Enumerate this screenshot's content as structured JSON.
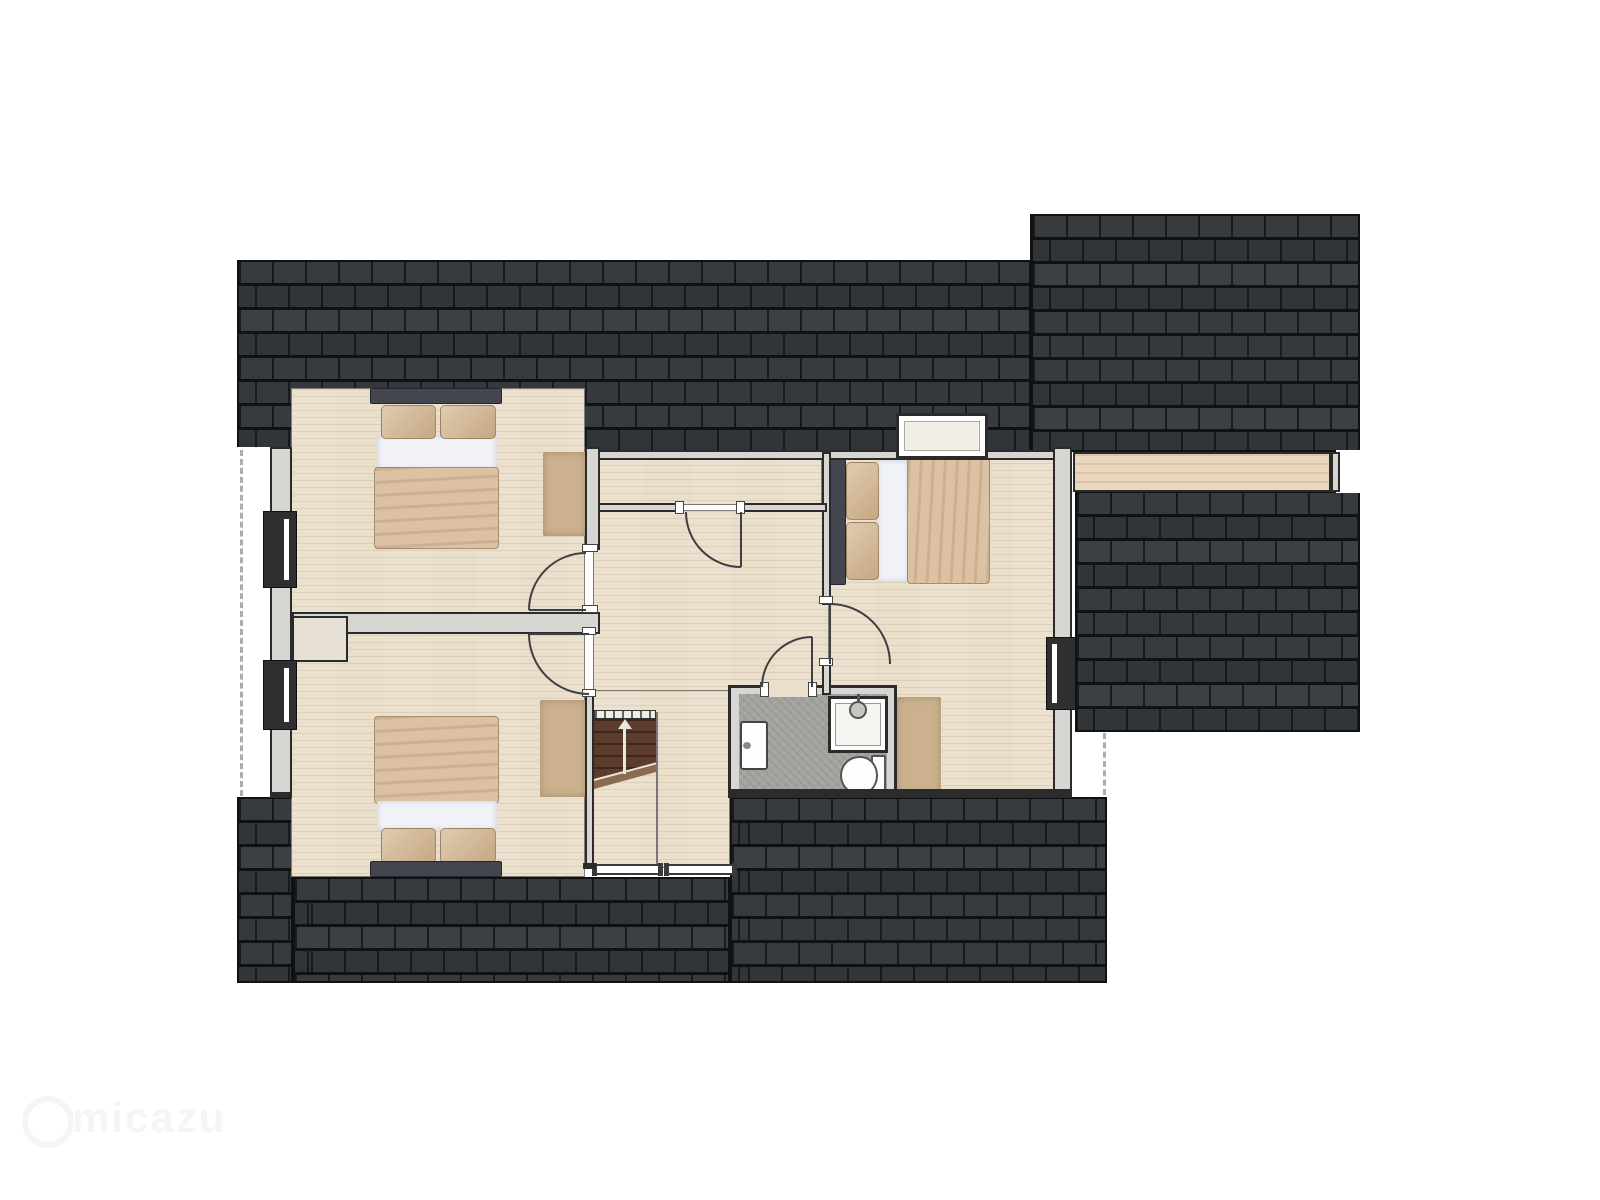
{
  "watermark": {
    "text": "micazu"
  },
  "stairs": {
    "direction": "up"
  },
  "plan": {
    "type": "floorplan-top-view",
    "level": "attic-floor",
    "rooms": [
      "bedroom-top-left",
      "bedroom-bottom-left",
      "bedroom-right",
      "bathroom",
      "landing-hallway",
      "corridor-closet"
    ],
    "fixtures": [
      "double-bed",
      "double-bed",
      "double-bed",
      "shower",
      "toilet",
      "washbasin",
      "staircase-up",
      "stair-railing"
    ],
    "windows": [
      "left-wall-window-1",
      "left-wall-window-2",
      "right-wall-window",
      "roof-skylight"
    ]
  },
  "palette": {
    "roof_tile": "#373b3d",
    "roof_tile_alt": "#313538",
    "roof_gap": "#17191a",
    "roof_line": "#0f1112",
    "floor": "#e9dfca",
    "wall_fill": "#d6d6d3",
    "outline": "#2b2b2b",
    "bath_floor": "#a3a39f",
    "duvet": "#dcc2a3",
    "pillow": "#d6ba96",
    "sheet": "#f0f2f6",
    "headboard": "#43464e",
    "rug": "#cbb18e",
    "stairs": "#5e3c2d",
    "stairs_line": "#3c271e",
    "dormer": "#ead7bf",
    "window_frame": "#2f2f31",
    "dash": "#a8adad",
    "watermark": "rgba(60,60,60,0.05)"
  }
}
